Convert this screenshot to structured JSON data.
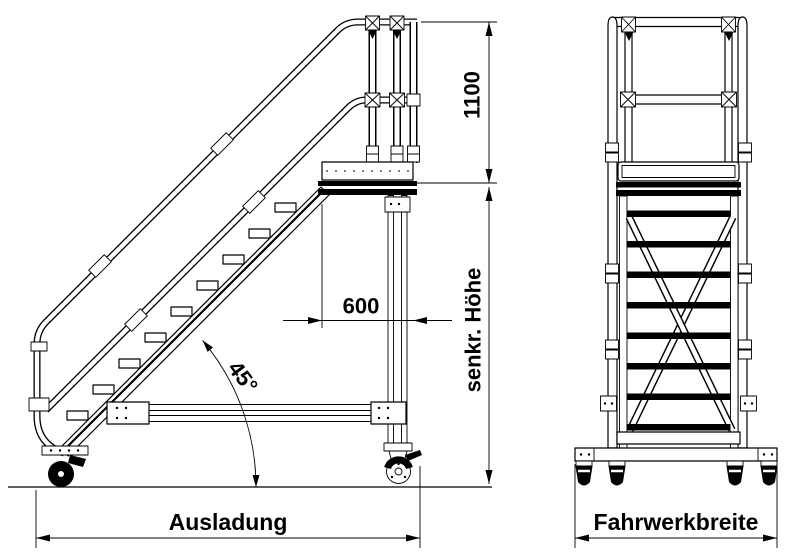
{
  "drawing": {
    "background": "#ffffff",
    "line_color": "#000000",
    "type": "technical-drawing",
    "views": {
      "side": "platform stairway side elevation",
      "front": "platform stairway front elevation"
    },
    "labels": {
      "rail_height": "1100",
      "platform_depth": "600",
      "incline_angle": "45°",
      "vertical_height": "senkr. Höhe",
      "outreach": "Ausladung",
      "chassis_width": "Fahrwerkbreite"
    }
  }
}
